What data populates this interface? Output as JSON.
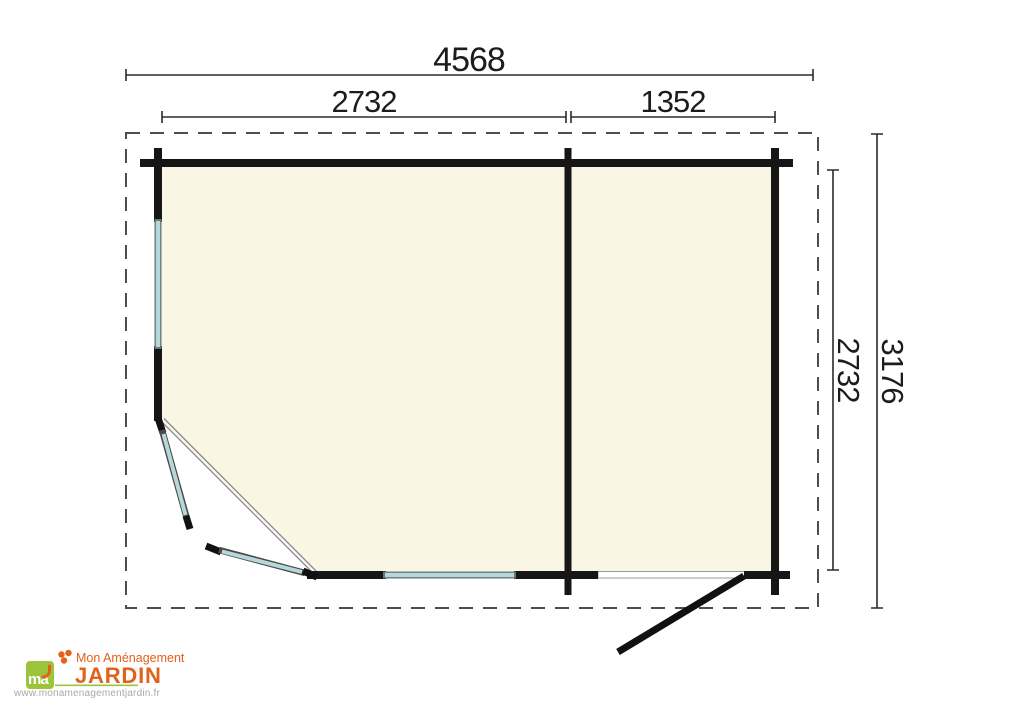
{
  "colors": {
    "background": "#ffffff",
    "floor": "#faf6e4",
    "wall": "#161616",
    "window": "#b7d8db",
    "window_edge": "#66797c",
    "dashed_border": "#4d4d4d",
    "dimension": "#2b2b2b",
    "opening_line": "#8a8a8a",
    "threshold_fill": "#ffffff",
    "threshold_edge": "#9a9a9a",
    "logo_green": "#9bc43c",
    "logo_orange": "#e2611b",
    "logo_url_grey": "#a9a9a9"
  },
  "dimensions": {
    "width_total": "4568",
    "width_left_room": "2732",
    "width_right_room": "1352",
    "depth_total": "3176",
    "depth_inner": "2732"
  },
  "logo": {
    "icon_text": "ma",
    "name_line1": "Mon Aménagement",
    "name_line2": "JARDIN",
    "website": "www.monamenagementjardin.fr"
  }
}
